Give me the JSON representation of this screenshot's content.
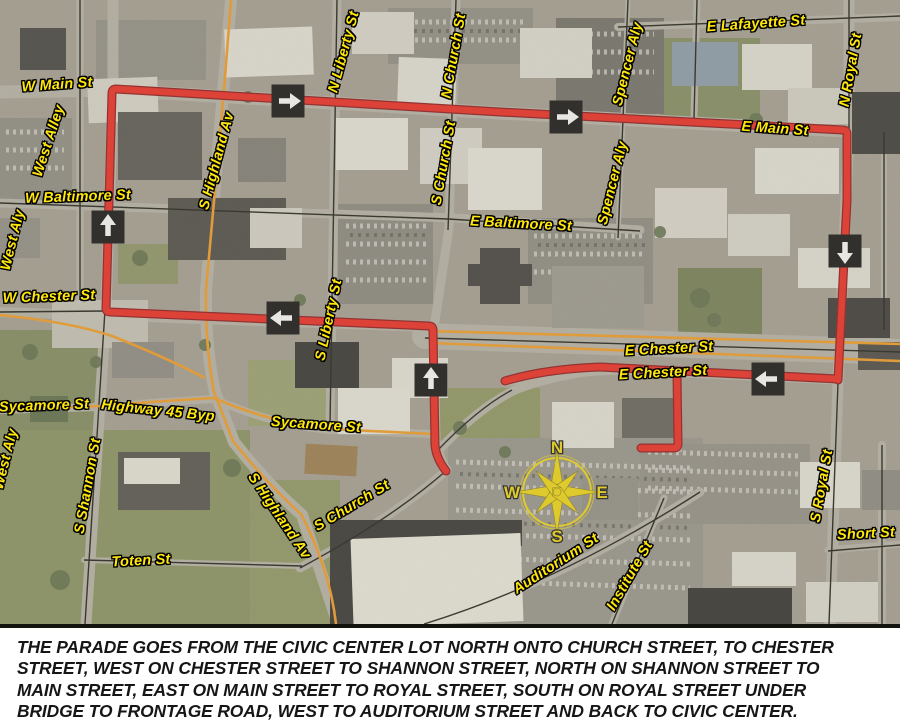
{
  "map": {
    "street_labels": [
      {
        "text": "W Main St"
      },
      {
        "text": "West Alley"
      },
      {
        "text": "W Baltimore St"
      },
      {
        "text": "West Aly"
      },
      {
        "text": "W Chester St"
      },
      {
        "text": "Sycamore St"
      },
      {
        "text": "Highway 45 Byp"
      },
      {
        "text": "S Shannon St"
      },
      {
        "text": "S Highland Av"
      },
      {
        "text": "S Highland Av"
      },
      {
        "text": "S Liberty St"
      },
      {
        "text": "N Liberty St"
      },
      {
        "text": "N Church St"
      },
      {
        "text": "S Church St"
      },
      {
        "text": "S Church St"
      },
      {
        "text": "E Baltimore St"
      },
      {
        "text": "E Main St"
      },
      {
        "text": "E Lafayette St"
      },
      {
        "text": "Spencer Aly"
      },
      {
        "text": "Spencer Aly"
      },
      {
        "text": "N Royal St"
      },
      {
        "text": "E Chester St"
      },
      {
        "text": "E Chester St"
      },
      {
        "text": "Sycamore St"
      },
      {
        "text": "S Royal St"
      },
      {
        "text": "Short St"
      },
      {
        "text": "Institute St"
      },
      {
        "text": "Auditorium St"
      },
      {
        "text": "Toten St"
      },
      {
        "text": "West Aly"
      }
    ],
    "compass": {
      "north": "N",
      "west": "W",
      "east": "E",
      "south": "S"
    },
    "route": {
      "color": "#f02318",
      "arrow_directions": [
        "right",
        "right",
        "up",
        "down",
        "left",
        "up",
        "left"
      ]
    },
    "label_color": "#ffe70c",
    "highway_color": "#f59a1d"
  },
  "caption": {
    "lines": [
      "THE PARADE GOES FROM THE CIVIC CENTER LOT NORTH ONTO CHURCH STREET, TO CHESTER",
      "STREET, WEST ON CHESTER STREET TO SHANNON STREET, NORTH ON SHANNON STREET TO",
      "MAIN STREET, EAST ON MAIN STREET TO ROYAL STREET, SOUTH ON ROYAL STREET UNDER",
      "BRIDGE TO FRONTAGE ROAD, WEST TO AUDITORIUM STREET AND BACK TO CIVIC CENTER."
    ]
  }
}
